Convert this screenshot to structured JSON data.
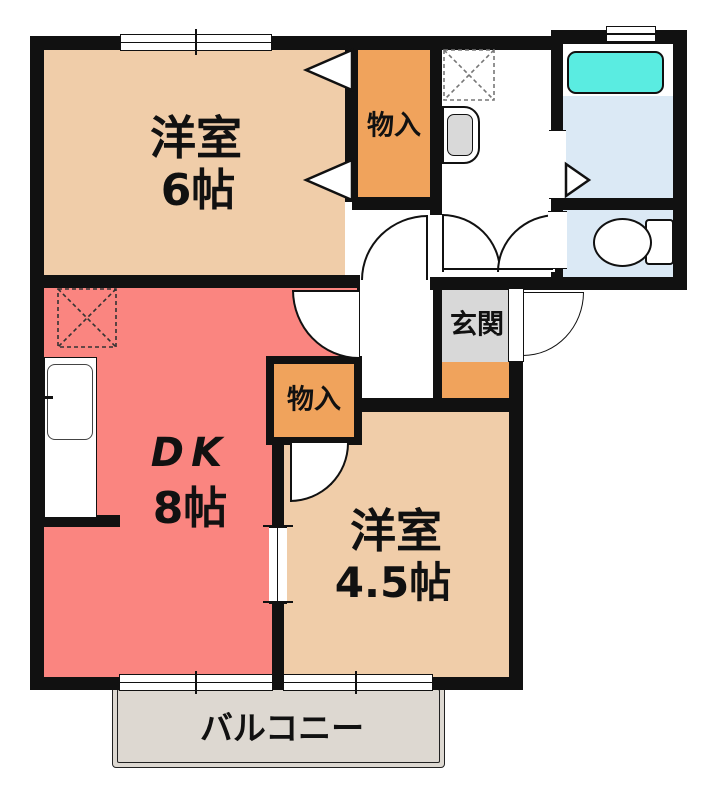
{
  "plan": {
    "rooms": {
      "western6": {
        "name": "洋室",
        "size": "6帖"
      },
      "dk": {
        "name": "DK",
        "size": "8帖"
      },
      "western45": {
        "name": "洋室",
        "size": "4.5帖"
      },
      "closet_north": {
        "label": "物入"
      },
      "closet_center": {
        "label": "物入"
      },
      "genkan": {
        "label": "玄関"
      },
      "balcony": {
        "label": "バルコニー"
      }
    },
    "colors": {
      "wall": "#111111",
      "western_room_floor": "#f0cda9",
      "dk_floor": "#fa8580",
      "closet": "#f0a35c",
      "genkan_tile": "#d8d8d8",
      "genkan_step": "#f0a35c",
      "wet_area_floor": "#dbe9f5",
      "bathtub": "#5aece1",
      "balcony_floor": "#ddd8d1"
    }
  }
}
